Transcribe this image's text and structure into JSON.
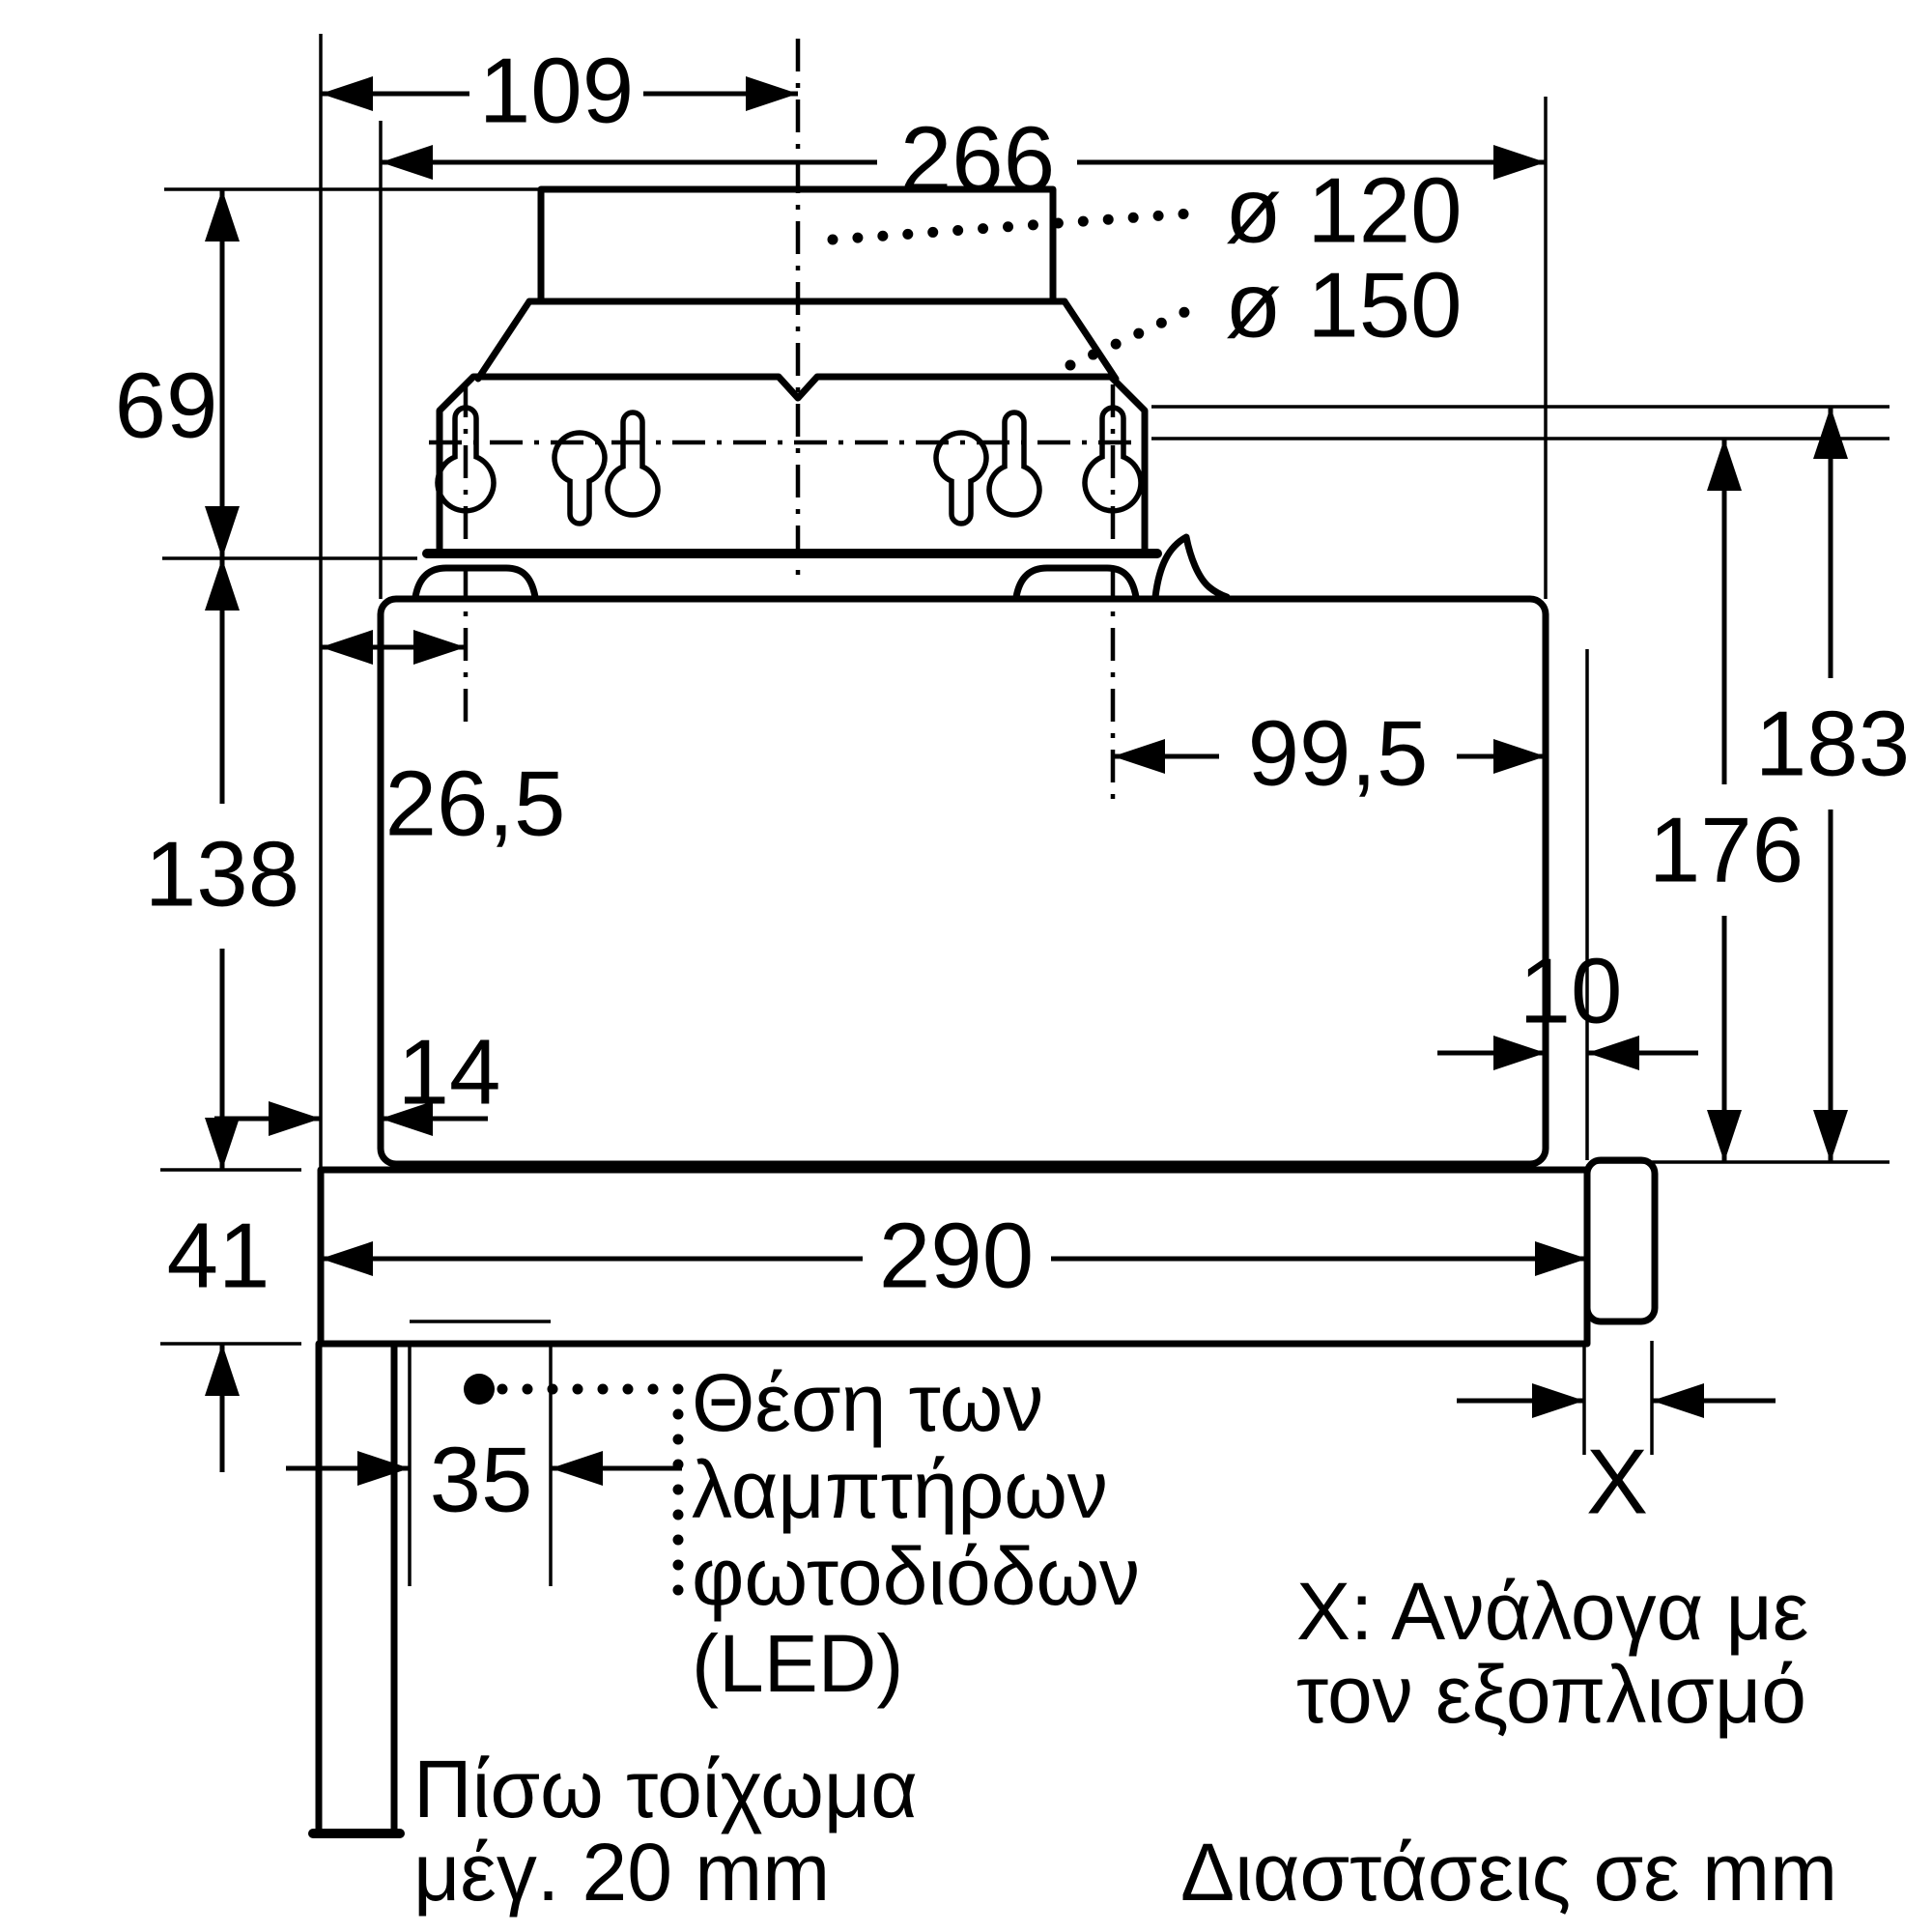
{
  "diagram": {
    "title_note": "Διαστάσεις σε mm",
    "colors": {
      "line": "#000000",
      "background": "#ffffff"
    },
    "dims": {
      "d109": "109",
      "d266": "266",
      "d120": "ø 120",
      "d150": "ø 150",
      "d69": "69",
      "d265": "26,5",
      "d995": "99,5",
      "d183": "183",
      "d176": "176",
      "d138": "138",
      "d14": "14",
      "d10": "10",
      "d41": "41",
      "d290": "290",
      "d35": "35",
      "dX": "X"
    },
    "annotations": {
      "led": [
        "Θέση των",
        "λαμπτήρων",
        "φωτοδιόδων",
        "(LED)"
      ],
      "x_note": [
        "Χ: Ανάλογα με",
        "τον εξοπλισμό"
      ],
      "wall_note": [
        "Πίσω τοίχωμα",
        "μέγ. 20 mm"
      ]
    }
  }
}
